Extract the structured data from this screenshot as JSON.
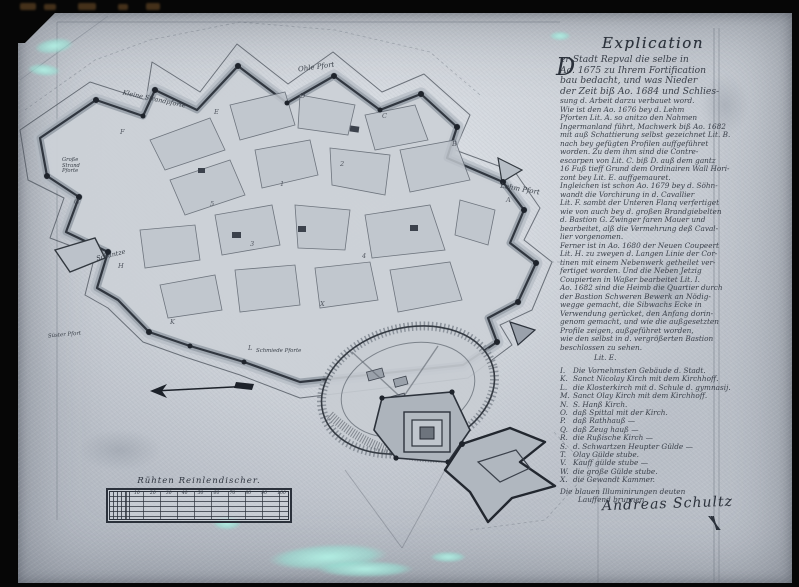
{
  "colors": {
    "paper": "#c6cbd2",
    "ink": "#2b313b",
    "wall": "#30363f",
    "cyan_stain": "#a9ecdf",
    "frame": "#060606"
  },
  "explication": {
    "title": "Explication",
    "initial_letter": "D",
    "paragraphs": [
      "er Stadt Repval die selbe in",
      "Ao. 1675 zu Ihrem Fortification",
      "bau bedacht, und was Nieder",
      "der Zeit biß Ao. 1684 und Schlies-",
      "sung d. Arbeit darzu verbauet word.",
      "Wie ist den Ao. 1676 bey d. Lehm",
      "Pforten Lit. A. so anitzo den Nahmen",
      "Ingermanland führt, Machwerk biß Ao. 1682",
      "mit auß Schattierung selbst gezeichnet Lit. B.",
      "nach bey gefügten Profilen auffgeführet",
      "worden.  Zu dem ihm sind die Contre-",
      "escarpen von Lit. C. biß D. auß dem gantz",
      "16 Fuß tieff Grund dem Ordinairen Wall Hori-",
      "zont bey Lit. E. auffgemauret.",
      "Ingleichen ist schon Ao. 1679 bey d. Söhn-",
      "wandt die Vorchirung in d. Cavallier",
      "Lit. F. sambt der Unteren Flanq verfertiget",
      "wie von auch bey d. großen Brandgiebelten",
      "d. Bastion G. Zwinger faren Mauer und",
      "bearbeitet, alß die Vermehrung deß Caval-",
      "lier vorgenomen.",
      "Ferner ist in Ao. 1680 der Neuen Coupeert",
      "Lit. H. zu zweyen d. Langen Linie der Cor-",
      "tinen mit einem Nebenwerk getheilet ver-",
      "fertiget worden.  Und die Neben Jetzig",
      "Coupierten in Waßer bearbeitet Lit. I.",
      "Ao. 1682 sind die Heimb die Quartier durch",
      "der Bastion Schweren Bewerk an Nödig-",
      "wegge gemacht, die Sibwachs Ecke in",
      "Verwendung gerücket, den Anfang dorin-",
      "genom gemacht, und wie die außgesetzten",
      "Profile zeigen, außgeführet worden,",
      "wie den selbst in d. vergrößerten Bastion",
      "beschlossen zu sehen.",
      "Lit. E."
    ],
    "legend": [
      {
        "letter": "I.",
        "text": "Die Vornehmsten Gebäude d. Stadt."
      },
      {
        "letter": "K.",
        "text": "Sanct Nicolay Kirch mit dem Kirchhoff."
      },
      {
        "letter": "L.",
        "text": "die Klosterkirch mit d. Schule d. gymnasij."
      },
      {
        "letter": "M.",
        "text": "Sanct Olay Kirch mit dem Kirchhoff."
      },
      {
        "letter": "N.",
        "text": "S. Hanß Kirch."
      },
      {
        "letter": "O.",
        "text": "daß Spittal mit der Kirch."
      },
      {
        "letter": "P.",
        "text": "daß Rathhauß  —"
      },
      {
        "letter": "Q.",
        "text": "daß Zeug hauß  —"
      },
      {
        "letter": "R.",
        "text": "die Rußische Kirch  —"
      },
      {
        "letter": "S.",
        "text": "d. Schwartzen Heupter Gülde  —"
      },
      {
        "letter": "T.",
        "text": "Olay Gülde stube."
      },
      {
        "letter": "V.",
        "text": "Kauff gülde stube  —"
      },
      {
        "letter": "W.",
        "text": "die große Gülde stube."
      },
      {
        "letter": "X.",
        "text": "die Gewandt Kammer."
      }
    ],
    "closing": [
      "Die blauen Illuminirungen deuten",
      "Lauffend brunnen."
    ],
    "signature": "Andreas Schultz"
  },
  "map_labels": {
    "kleine_strandpforte": "Kleine Strandpforte",
    "ohle_pfort": "Ohle Pfort",
    "grosse_strand_pforte": "Große Strand Pforte",
    "lehm_pfort": "Lehm Pfort",
    "schantze": "Schantze",
    "schmiede_pforte": "Schmiede Pforte",
    "suester_pfort": "Süster Pfort"
  },
  "map_markers": [
    {
      "ch": "A",
      "x": 506,
      "y": 196
    },
    {
      "ch": "B",
      "x": 452,
      "y": 140
    },
    {
      "ch": "C",
      "x": 382,
      "y": 112
    },
    {
      "ch": "D",
      "x": 300,
      "y": 92
    },
    {
      "ch": "E",
      "x": 214,
      "y": 108
    },
    {
      "ch": "F",
      "x": 120,
      "y": 128
    },
    {
      "ch": "G",
      "x": 74,
      "y": 198
    },
    {
      "ch": "H",
      "x": 118,
      "y": 262
    },
    {
      "ch": "K",
      "x": 170,
      "y": 318
    },
    {
      "ch": "L",
      "x": 248,
      "y": 344
    },
    {
      "ch": "1",
      "x": 280,
      "y": 180
    },
    {
      "ch": "2",
      "x": 340,
      "y": 160
    },
    {
      "ch": "3",
      "x": 250,
      "y": 240
    },
    {
      "ch": "4",
      "x": 362,
      "y": 252
    },
    {
      "ch": "5",
      "x": 210,
      "y": 200
    },
    {
      "ch": "X",
      "x": 320,
      "y": 300
    }
  ],
  "scale_bar": {
    "title": "Rühten Reinlendischer.",
    "ticks": [
      "10",
      "20",
      "30",
      "40",
      "50",
      "60",
      "70",
      "80",
      "90",
      "100"
    ]
  }
}
